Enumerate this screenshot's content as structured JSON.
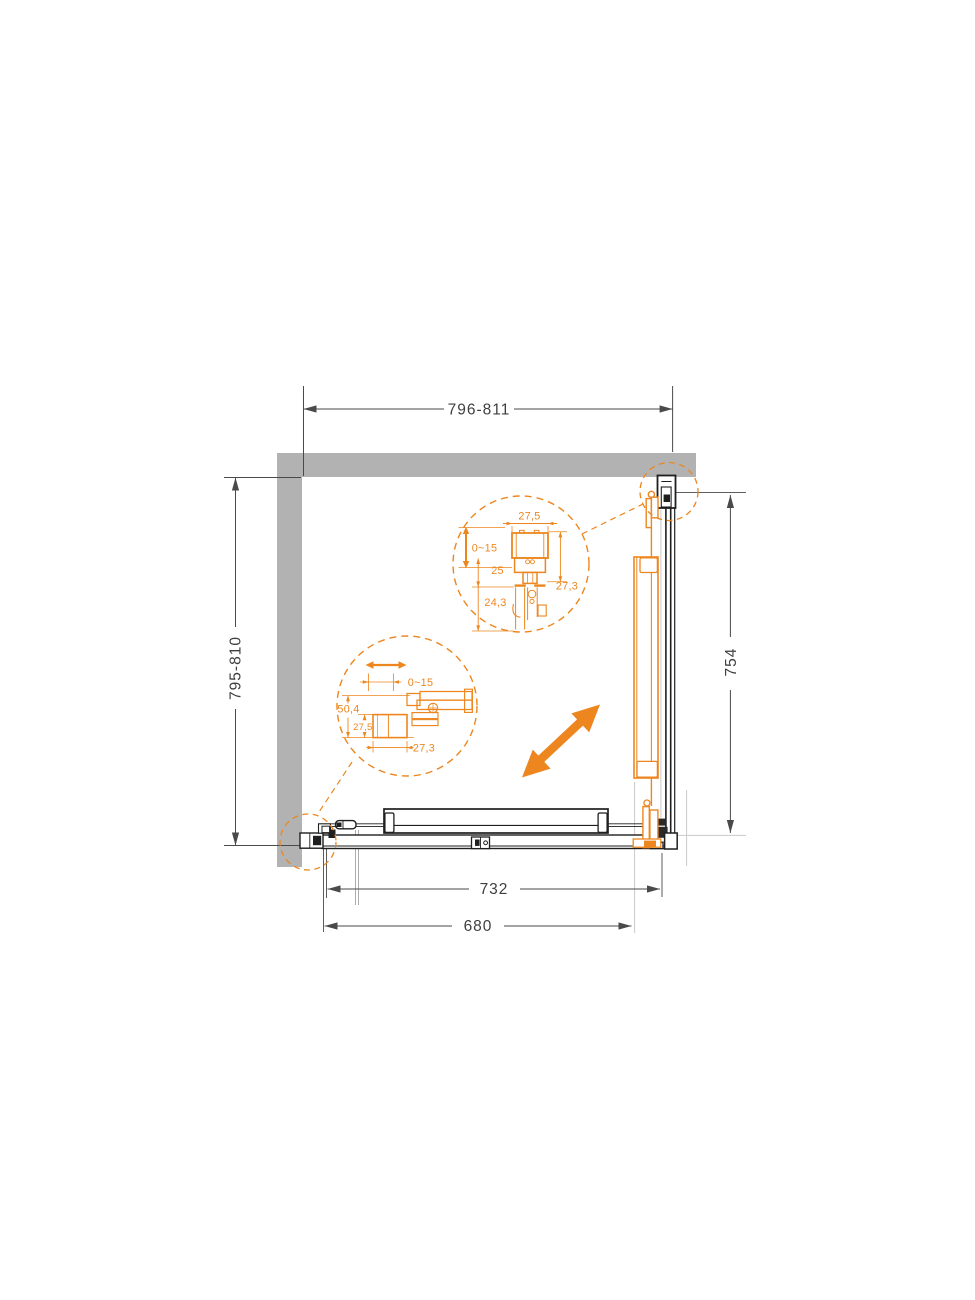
{
  "meta": {
    "title": "Shower enclosure installation plan drawing"
  },
  "colors": {
    "accent_orange": "#ED861F",
    "wall_gray": "#B2B2B2",
    "line_black": "#1F1F1F",
    "dim_gray": "#4A4A4A"
  },
  "dims": {
    "top": "796-811",
    "left": "795-810",
    "right": "754",
    "bottom_track": "732",
    "bottom_glass": "680"
  },
  "detail_top": {
    "width": "27,5",
    "adjust": "0~15",
    "inset": "25",
    "side": "27,3",
    "lower": "24,3"
  },
  "detail_left": {
    "adjust": "0~15",
    "height": "50,4",
    "block": "27,5",
    "width": "27,3"
  }
}
